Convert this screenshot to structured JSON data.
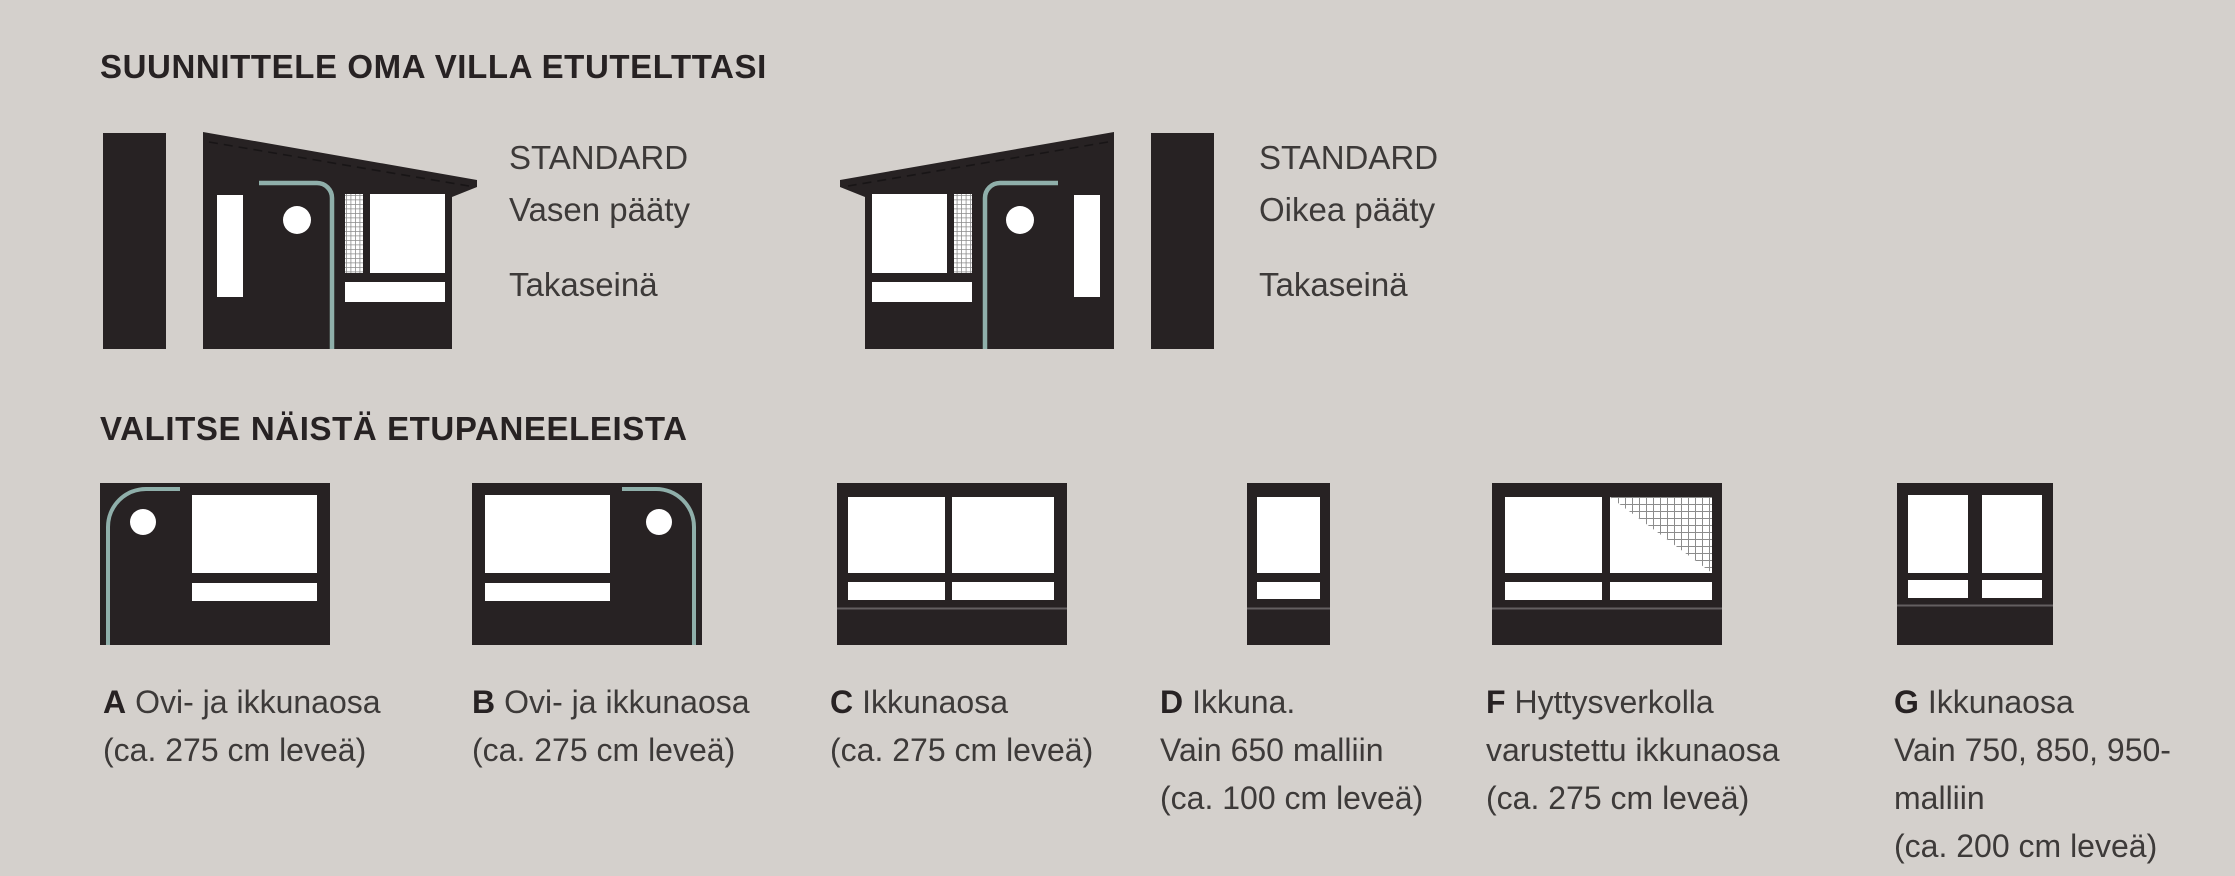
{
  "header": {
    "title": "SUUNNITTELE OMA VILLA ETUTELTTASI"
  },
  "panel_section": {
    "title": "VALITSE NÄISTÄ ETUPANEELEISTA"
  },
  "standard_ends": [
    {
      "tier": "STANDARD",
      "end": "Vasen pääty",
      "wall": "Takaseinä"
    },
    {
      "tier": "STANDARD",
      "end": "Oikea pääty",
      "wall": "Takaseinä"
    }
  ],
  "panels": [
    {
      "letter": "A",
      "line1": "Ovi- ja ikkunaosa",
      "line2": "(ca. 275 cm leveä)",
      "line3": "",
      "line4": ""
    },
    {
      "letter": "B",
      "line1": "Ovi- ja ikkunaosa",
      "line2": "(ca. 275 cm leveä)",
      "line3": "",
      "line4": ""
    },
    {
      "letter": "C",
      "line1": "Ikkunaosa",
      "line2": "(ca. 275 cm leveä)",
      "line3": "",
      "line4": ""
    },
    {
      "letter": "D",
      "line1": "Ikkuna.",
      "line2": "Vain 650 malliin",
      "line3": "(ca. 100 cm leveä)",
      "line4": ""
    },
    {
      "letter": "F",
      "line1": "Hyttysverkolla",
      "line2": "varustettu ikkunaosa",
      "line3": "(ca. 275 cm leveä)",
      "line4": ""
    },
    {
      "letter": "G",
      "line1": "Ikkunaosa",
      "line2": "Vain 750, 850, 950-",
      "line3": "malliin",
      "line4": "(ca. 200 cm leveä)"
    }
  ],
  "colors": {
    "background": "#d4d0cc",
    "dark": "#272223",
    "teal": "#8fafaa",
    "text": "#3d3a39",
    "mesh_line": "#8c8c8c",
    "white": "#ffffff"
  }
}
